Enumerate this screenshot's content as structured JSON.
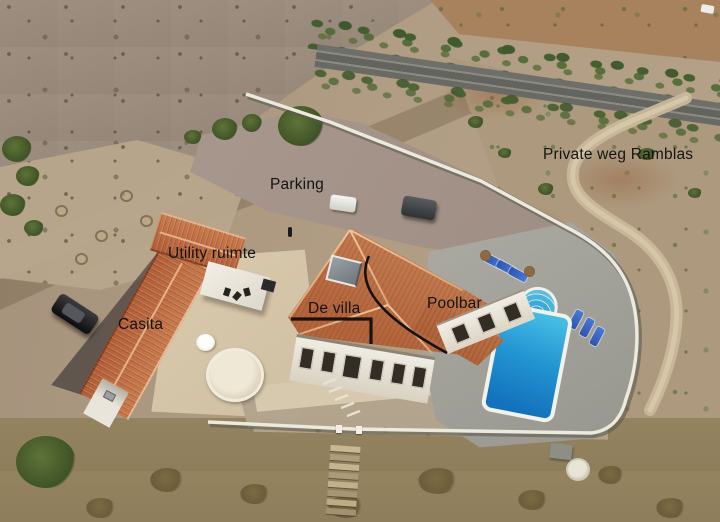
{
  "scene": {
    "title": "Aerial drone photo of a villa property with hand-placed text annotations",
    "annotation_text_color": "#141414"
  },
  "labels": [
    {
      "id": "private-weg-ramblas",
      "text": "Private weg Ramblas"
    },
    {
      "id": "parking",
      "text": "Parking"
    },
    {
      "id": "utility-ruimte",
      "text": "Utility ruimte"
    },
    {
      "id": "casita",
      "text": "Casita"
    },
    {
      "id": "de-villa",
      "text": "De villa"
    },
    {
      "id": "poolbar",
      "text": "Poolbar"
    }
  ],
  "palette": {
    "pool_water": "#2196d2",
    "roof_tiles": "#b96a42",
    "perimeter_wall": "#eceade",
    "asphalt_road": "#6b6b66",
    "gravel_parking": "#a4948a",
    "scrub_terrain": "#a5927c",
    "paving": "#d6c9ae"
  }
}
